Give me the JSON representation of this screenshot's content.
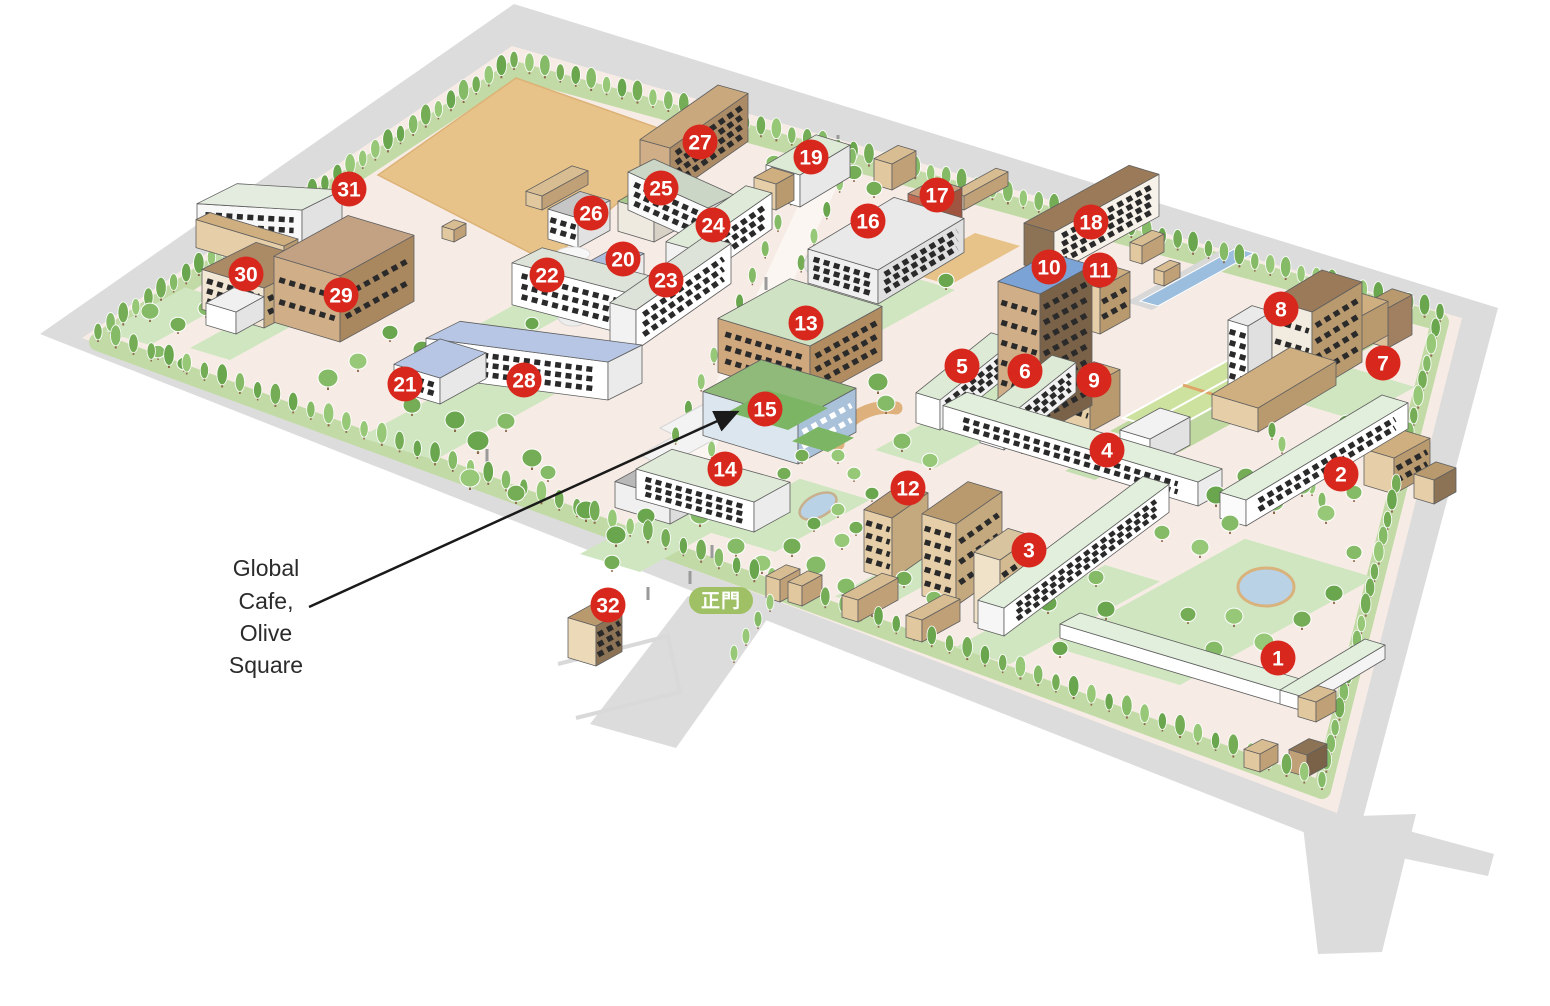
{
  "map": {
    "colors": {
      "marker_bg": "#d8281d",
      "marker_text": "#ffffff",
      "gate_bg": "#9fc065",
      "gate_text": "#ffffff",
      "annotation_text": "#2b2b2b",
      "arrow": "#1a1a1a",
      "road": "#dcdcdc",
      "ground": "#f7ece5",
      "field": "#e7c289",
      "water": "#9cbede",
      "lawn": "#cfe6c0"
    },
    "gate": {
      "label": "正門"
    },
    "annotation": {
      "lines": [
        "Global",
        "Cafe,",
        "Olive",
        "Square"
      ]
    },
    "markers": [
      {
        "n": 1,
        "x": 1278,
        "y": 658
      },
      {
        "n": 2,
        "x": 1341,
        "y": 474
      },
      {
        "n": 3,
        "x": 1029,
        "y": 550
      },
      {
        "n": 4,
        "x": 1107,
        "y": 450
      },
      {
        "n": 5,
        "x": 962,
        "y": 366
      },
      {
        "n": 6,
        "x": 1025,
        "y": 371
      },
      {
        "n": 7,
        "x": 1383,
        "y": 363
      },
      {
        "n": 8,
        "x": 1281,
        "y": 309
      },
      {
        "n": 9,
        "x": 1094,
        "y": 380
      },
      {
        "n": 10,
        "x": 1049,
        "y": 267
      },
      {
        "n": 11,
        "x": 1100,
        "y": 270
      },
      {
        "n": 12,
        "x": 908,
        "y": 488
      },
      {
        "n": 13,
        "x": 806,
        "y": 323
      },
      {
        "n": 14,
        "x": 725,
        "y": 469
      },
      {
        "n": 15,
        "x": 765,
        "y": 409
      },
      {
        "n": 16,
        "x": 868,
        "y": 221
      },
      {
        "n": 17,
        "x": 937,
        "y": 195
      },
      {
        "n": 18,
        "x": 1091,
        "y": 222
      },
      {
        "n": 19,
        "x": 811,
        "y": 157
      },
      {
        "n": 20,
        "x": 623,
        "y": 259
      },
      {
        "n": 21,
        "x": 405,
        "y": 384
      },
      {
        "n": 22,
        "x": 547,
        "y": 275
      },
      {
        "n": 23,
        "x": 666,
        "y": 280
      },
      {
        "n": 24,
        "x": 713,
        "y": 225
      },
      {
        "n": 25,
        "x": 661,
        "y": 188
      },
      {
        "n": 26,
        "x": 591,
        "y": 213
      },
      {
        "n": 27,
        "x": 700,
        "y": 142
      },
      {
        "n": 28,
        "x": 524,
        "y": 380
      },
      {
        "n": 29,
        "x": 341,
        "y": 295
      },
      {
        "n": 30,
        "x": 246,
        "y": 274
      },
      {
        "n": 31,
        "x": 349,
        "y": 189
      },
      {
        "n": 32,
        "x": 608,
        "y": 605
      }
    ]
  }
}
